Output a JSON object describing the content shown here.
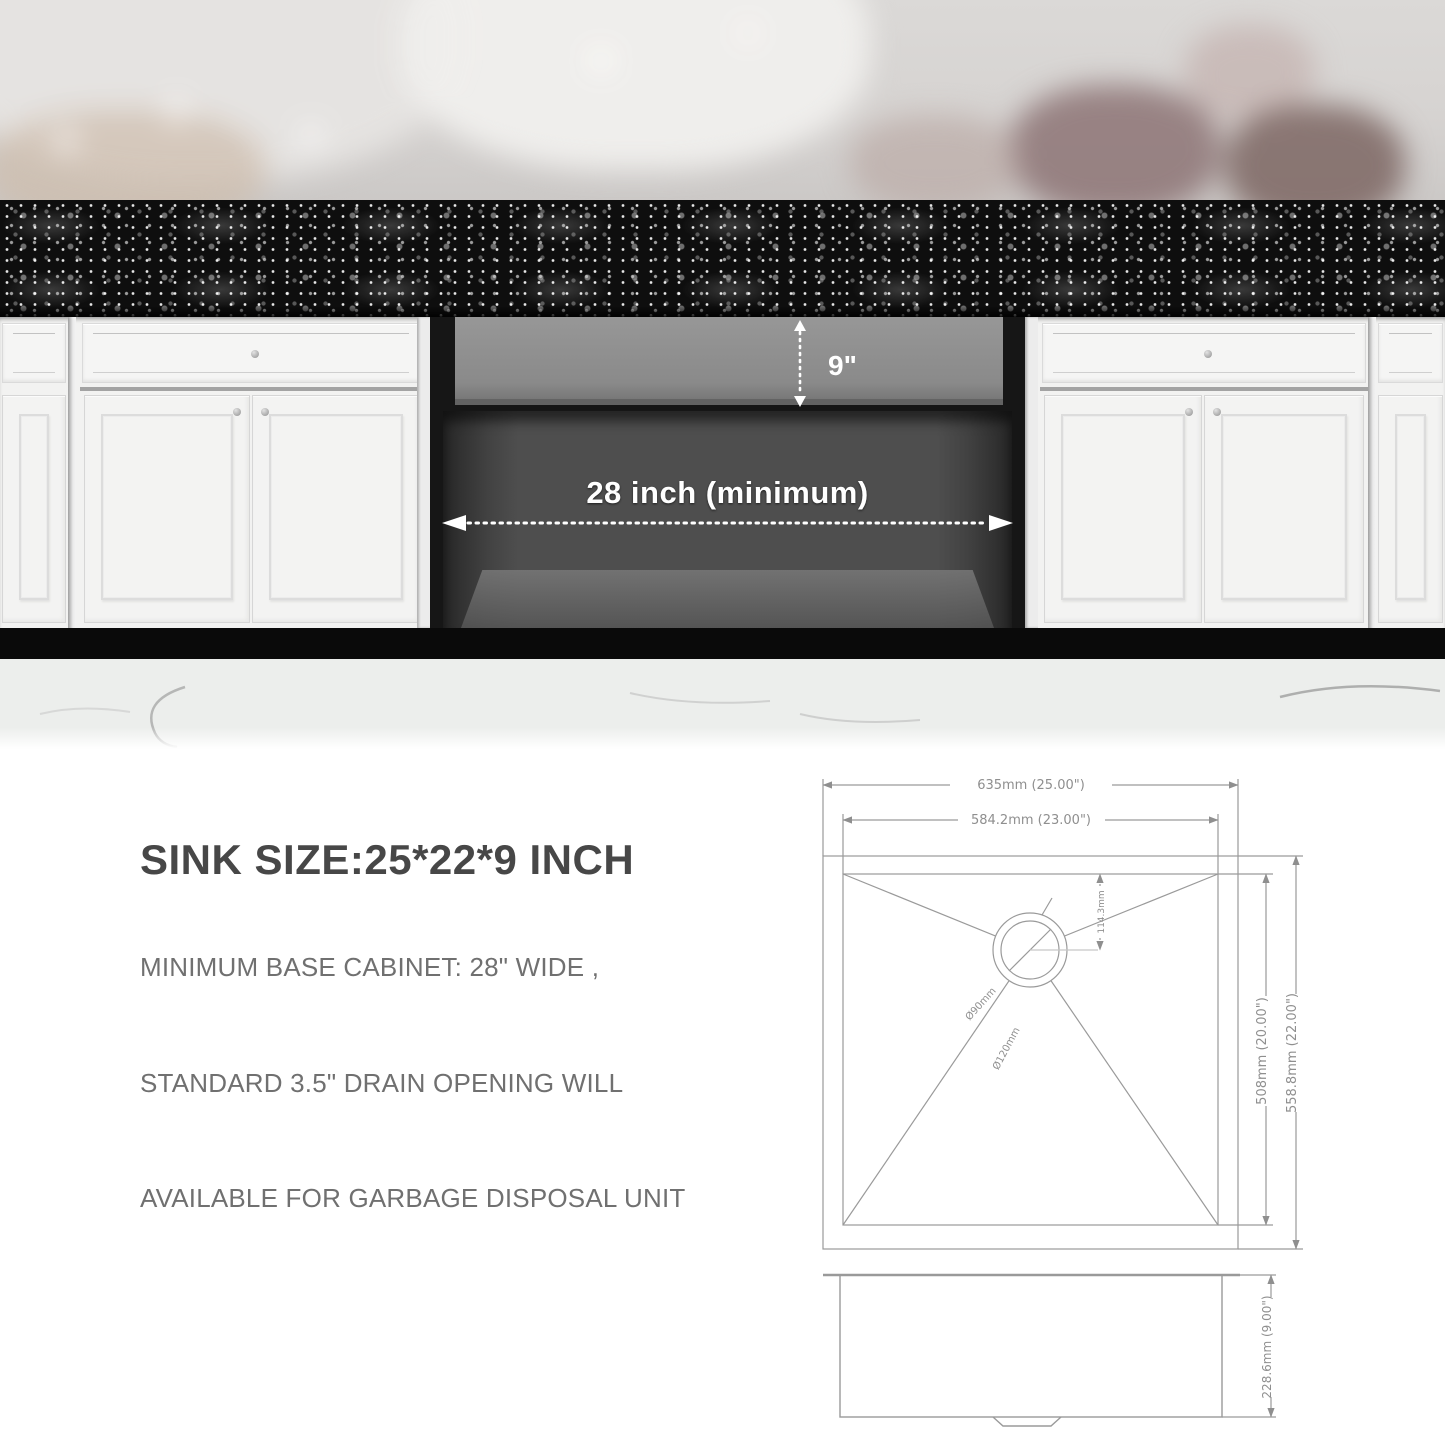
{
  "photo_section": {
    "countertop_cutout_label": "25 inch (minimum)",
    "sink_depth_label": "9\"",
    "base_cabinet_label": "28 inch (minimum)"
  },
  "specs": {
    "title": "SINK SIZE:25*22*9 INCH",
    "lines": [
      "MINIMUM BASE CABINET: 28\" WIDE ,",
      "STANDARD 3.5\" DRAIN OPENING WILL",
      "AVAILABLE FOR GARBAGE DISPOSAL UNIT"
    ]
  },
  "drawings": {
    "top_view": {
      "overall_width": "635mm (25.00\")",
      "bowl_width": "584.2mm (23.00\")",
      "bowl_depth": "508mm (20.00\")",
      "overall_depth": "558.8mm (22.00\")",
      "drain_offset": "114.3mm",
      "drain_diameter_inner": "Ø90mm",
      "drain_diameter_outer": "Ø120mm"
    },
    "side_view": {
      "bowl_height": "228.6mm (9.00\")"
    }
  },
  "colors": {
    "granite": "#0e0e0e",
    "cabinet_white": "#f2f2f1",
    "opening_dark": "#161616",
    "sink_gray": "#8a8a8a",
    "interior_gray": "#4e4e4e",
    "banner_white": "#f8f8f6",
    "arrow_white": "#ffffff",
    "drawing_stroke": "#9a9a9a",
    "heading_text": "#474747",
    "body_text": "#707070"
  }
}
